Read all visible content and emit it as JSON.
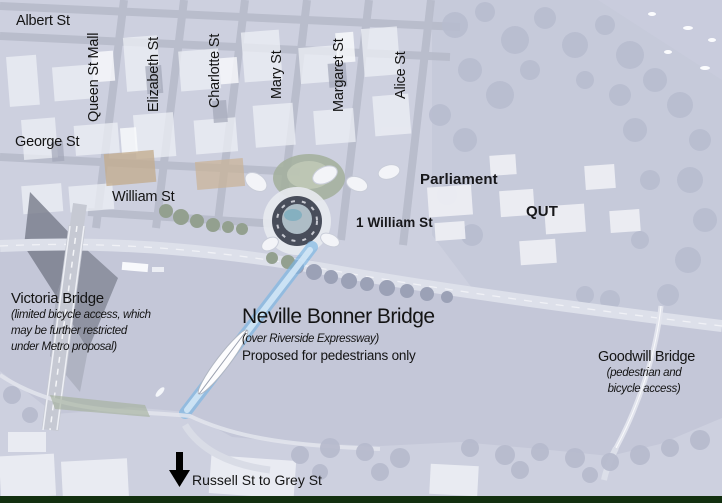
{
  "streets": {
    "albert": "Albert St",
    "queen_mall": "Queen St Mall",
    "elizabeth": "Elizabeth St",
    "charlotte": "Charlotte St",
    "mary": "Mary St",
    "margaret": "Margaret St",
    "alice": "Alice St",
    "george": "George St",
    "william": "William St"
  },
  "places": {
    "parliament": "Parliament",
    "one_william": "1 William St",
    "qut": "QUT"
  },
  "bridges": {
    "victoria": {
      "name": "Victoria Bridge",
      "note_lines": [
        "(limited bicycle access, which",
        "may be further restricted",
        "under Metro proposal)"
      ]
    },
    "neville_bonner": {
      "name": "Neville Bonner Bridge",
      "subtitle": "(over Riverside Expressway)",
      "status": "Proposed for pedestrians only",
      "highlight_color": "#7ab6e4"
    },
    "goodwill": {
      "name": "Goodwill Bridge",
      "note_lines": [
        "(pedestrian and",
        "bicycle access)"
      ]
    }
  },
  "arrow_note": {
    "text": "Russell St to Grey St",
    "direction": "down",
    "arrow_color": "#000000"
  },
  "map_colors": {
    "land": "#cdd0df",
    "river": "#c4c7d8",
    "bridge_highlight": "#7ab6e4",
    "bottom_band": "#133010"
  }
}
